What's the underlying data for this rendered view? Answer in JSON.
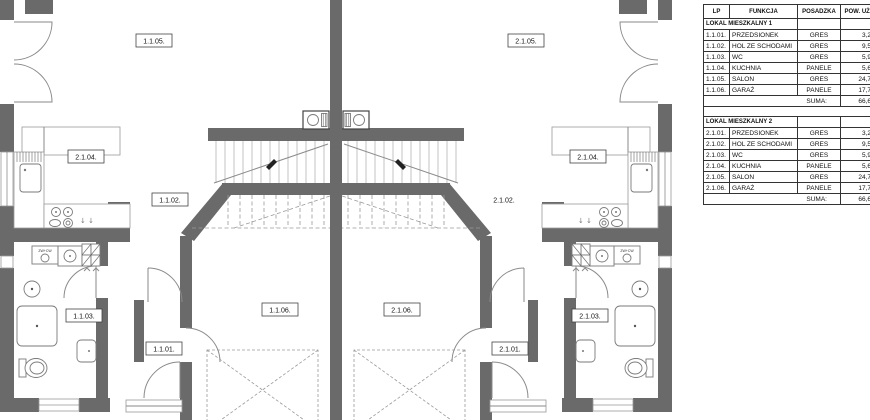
{
  "plan": {
    "labels": {
      "left_salon": "1.1.05.",
      "left_kitchen": "2.1.04.",
      "left_hall": "1.1.02.",
      "left_wc": "1.1.03.",
      "left_entry": "1.1.01.",
      "left_garage": "1.1.06.",
      "right_salon": "2.1.05.",
      "right_kitchen": "2.1.04.",
      "right_hall": "2.1.02.",
      "right_wc": "2.1.03.",
      "right_entry": "2.1.01.",
      "right_garage": "2.1.06.",
      "washer_left": "ZW+CW",
      "washer_right": "ZW+CW",
      "kitchen_arrows_left": "↓ ↓",
      "kitchen_arrows_right": "↓ ↓"
    },
    "colors": {
      "wall": "#6a6a6a",
      "line": "#9a9a9a"
    }
  },
  "table": {
    "headers": [
      "LP",
      "FUNKCJA",
      "POSADZKA",
      "POW. UŻYTK."
    ],
    "sections": [
      {
        "title": "LOKAL MIESZKALNY 1",
        "rows": [
          [
            "1.1.01.",
            "PRZEDSIONEK",
            "GRES",
            "3,20 m²"
          ],
          [
            "1.1.02.",
            "HOL ZE SCHODAMI",
            "GRES",
            "9,50 m²"
          ],
          [
            "1.1.03.",
            "WC",
            "GRES",
            "5,90 m²"
          ],
          [
            "1.1.04.",
            "KUCHNIA",
            "PANELE",
            "5,60 m²"
          ],
          [
            "1.1.05.",
            "SALON",
            "GRES",
            "24,70 m²"
          ],
          [
            "1.1.06.",
            "GARAŻ",
            "PANELE",
            "17,70 m²"
          ]
        ],
        "sum_label": "SUMA:",
        "sum_value": "66,60 m²"
      },
      {
        "title": "LOKAL MIESZKALNY 2",
        "rows": [
          [
            "2.1.01.",
            "PRZEDSIONEK",
            "GRES",
            "3,20 m²"
          ],
          [
            "2.1.02.",
            "HOL ZE SCHODAMI",
            "GRES",
            "9,50 m²"
          ],
          [
            "2.1.03.",
            "WC",
            "GRES",
            "5,90 m²"
          ],
          [
            "2.1.04.",
            "KUCHNIA",
            "PANELE",
            "5,60 m²"
          ],
          [
            "2.1.05.",
            "SALON",
            "GRES",
            "24,70 m²"
          ],
          [
            "2.1.06.",
            "GARAŻ",
            "PANELE",
            "17,70 m²"
          ]
        ],
        "sum_label": "SUMA:",
        "sum_value": "66,60 m²"
      }
    ]
  }
}
